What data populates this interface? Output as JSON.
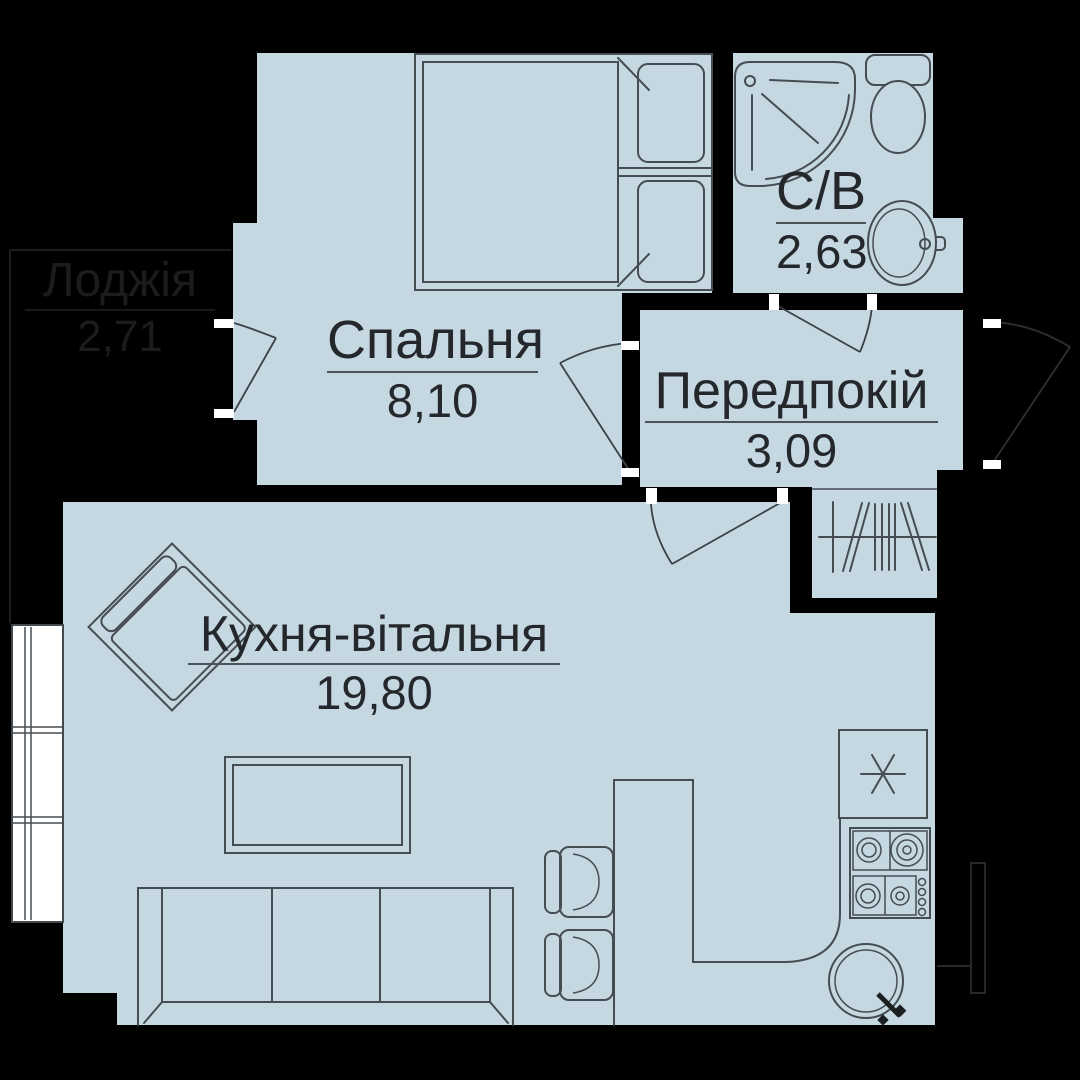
{
  "plan": {
    "title": "apartment-floor-plan",
    "colors": {
      "background": "#000000",
      "room_fill": "#c5d7e1",
      "line": "#454c52",
      "text": "#24282c",
      "tick_white": "#ffffff",
      "faint_outside": "#1d1d1d"
    },
    "rooms": [
      {
        "id": "bedroom",
        "name": "Спальня",
        "area": "8,10"
      },
      {
        "id": "bathroom",
        "name": "С/В",
        "area": "2,63"
      },
      {
        "id": "hallway",
        "name": "Передпокій",
        "area": "3,09"
      },
      {
        "id": "kitchen_living",
        "name": "Кухня-вітальня",
        "area": "19,80"
      },
      {
        "id": "loggia",
        "name": "Лоджія",
        "area": "2,71"
      }
    ],
    "fixtures": [
      "double-bed",
      "pillows",
      "shower-tray",
      "toilet",
      "washbasin",
      "wardrobe-hangers",
      "sofa",
      "coffee-table",
      "armchair",
      "bar-counter",
      "bar-chairs",
      "fridge-snowflake",
      "gas-stove",
      "round-kitchen-sink",
      "balcony-window",
      "door-swings",
      "dimension-ticks"
    ]
  }
}
